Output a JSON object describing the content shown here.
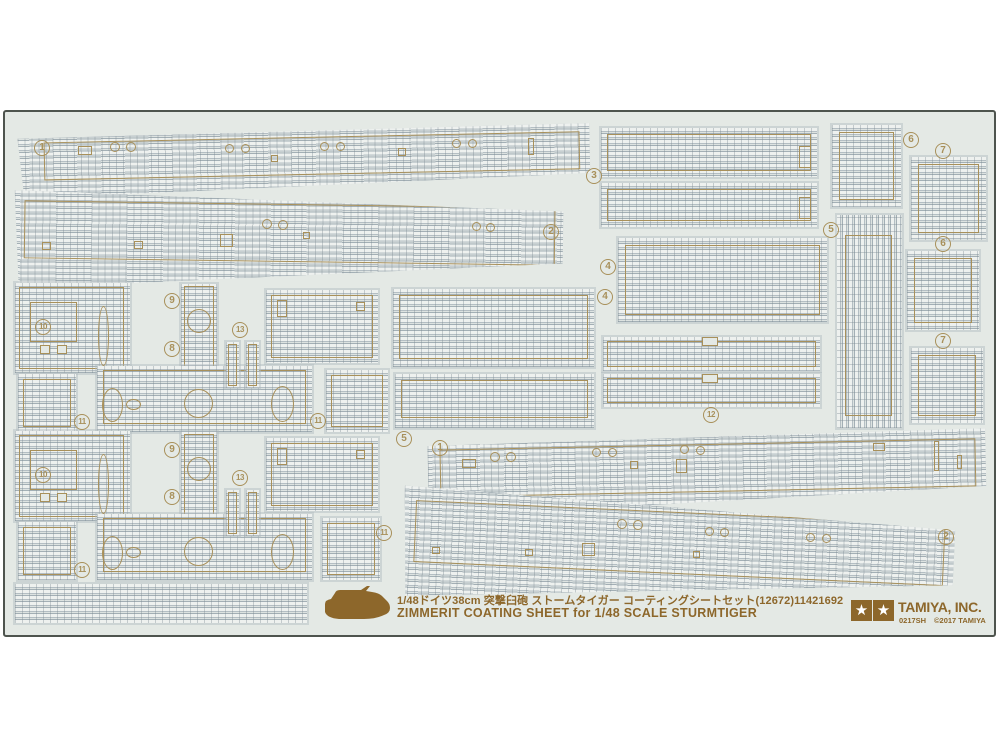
{
  "product": {
    "caption_jp": "1/48ドイツ38cm 突撃臼砲 ストームタイガー コーティングシートセット(12672)11421692",
    "caption_en": "ZIMMERIT COATING SHEET for 1/48 SCALE  STURMTIGER",
    "brand": "TAMIYA, INC.",
    "item_code": "0217SH",
    "copyright": "©2017 TAMIYA",
    "star_glyph": "★"
  },
  "colors": {
    "outline_tan": "#a8905a",
    "print_brown": "#8d672b",
    "sheet_bg": "#e4e9e5",
    "sheet_border": "#4e544e",
    "texture_base": "#d3dad9"
  },
  "part_badges": [
    {
      "n": "1",
      "x": 42,
      "y": 148
    },
    {
      "n": "2",
      "x": 551,
      "y": 232
    },
    {
      "n": "3",
      "x": 594,
      "y": 176
    },
    {
      "n": "4",
      "x": 608,
      "y": 267
    },
    {
      "n": "4",
      "x": 605,
      "y": 297
    },
    {
      "n": "5",
      "x": 831,
      "y": 230
    },
    {
      "n": "5",
      "x": 404,
      "y": 439
    },
    {
      "n": "6",
      "x": 911,
      "y": 140
    },
    {
      "n": "6",
      "x": 943,
      "y": 244
    },
    {
      "n": "7",
      "x": 943,
      "y": 151
    },
    {
      "n": "7",
      "x": 943,
      "y": 341
    },
    {
      "n": "8",
      "x": 172,
      "y": 349
    },
    {
      "n": "9",
      "x": 172,
      "y": 301
    },
    {
      "n": "10",
      "x": 43,
      "y": 327
    },
    {
      "n": "11",
      "x": 82,
      "y": 422
    },
    {
      "n": "11",
      "x": 318,
      "y": 421
    },
    {
      "n": "12",
      "x": 711,
      "y": 415
    },
    {
      "n": "13",
      "x": 240,
      "y": 330
    },
    {
      "n": "1",
      "x": 440,
      "y": 448
    },
    {
      "n": "2",
      "x": 946,
      "y": 537
    },
    {
      "n": "8",
      "x": 172,
      "y": 497
    },
    {
      "n": "9",
      "x": 172,
      "y": 450
    },
    {
      "n": "10",
      "x": 43,
      "y": 475
    },
    {
      "n": "11",
      "x": 82,
      "y": 570
    },
    {
      "n": "11",
      "x": 384,
      "y": 533
    },
    {
      "n": "13",
      "x": 240,
      "y": 478
    }
  ],
  "pieces": [
    {
      "x": 18,
      "y": 129,
      "w": 572,
      "h": 64,
      "rot": -1.2,
      "clip": "polygon(0 6%,100% 0,100% 78%,1% 100%)",
      "inset": [
        8,
        10,
        18,
        26
      ]
    },
    {
      "x": 14,
      "y": 194,
      "w": 549,
      "h": 98,
      "rot": 0.8,
      "clip": "polygon(0 0,100% 14%,100% 67%,1% 100%)",
      "inset": [
        10,
        8,
        30,
        10
      ]
    },
    {
      "x": 601,
      "y": 128,
      "w": 216,
      "h": 49,
      "inset": [
        6,
        6,
        6,
        6
      ]
    },
    {
      "x": 601,
      "y": 183,
      "w": 216,
      "h": 44,
      "inset": [
        6,
        6,
        6,
        6
      ]
    },
    {
      "x": 618,
      "y": 238,
      "w": 209,
      "h": 84,
      "inset": [
        7,
        7,
        7,
        7
      ]
    },
    {
      "x": 393,
      "y": 289,
      "w": 201,
      "h": 78,
      "inset": [
        6,
        6,
        8,
        6
      ]
    },
    {
      "x": 395,
      "y": 374,
      "w": 199,
      "h": 54,
      "inset": [
        6,
        6,
        10,
        6
      ]
    },
    {
      "x": 603,
      "y": 337,
      "w": 217,
      "h": 34,
      "inset": [
        4,
        4,
        4,
        4
      ]
    },
    {
      "x": 603,
      "y": 374,
      "w": 217,
      "h": 33,
      "inset": [
        4,
        4,
        4,
        4
      ]
    },
    {
      "x": 837,
      "y": 215,
      "w": 65,
      "h": 213,
      "v": true,
      "inset": [
        20,
        10,
        12,
        8
      ]
    },
    {
      "x": 832,
      "y": 125,
      "w": 69,
      "h": 82,
      "inset": [
        7,
        7,
        7,
        7
      ]
    },
    {
      "x": 911,
      "y": 157,
      "w": 75,
      "h": 83,
      "inset": [
        7,
        7,
        7,
        7
      ]
    },
    {
      "x": 907,
      "y": 251,
      "w": 72,
      "h": 79,
      "inset": [
        7,
        7,
        7,
        7
      ]
    },
    {
      "x": 911,
      "y": 348,
      "w": 72,
      "h": 75,
      "inset": [
        7,
        7,
        7,
        7
      ]
    },
    {
      "x": 15,
      "y": 283,
      "w": 115,
      "h": 90,
      "inset": [
        4,
        6,
        4,
        4
      ]
    },
    {
      "x": 181,
      "y": 284,
      "w": 36,
      "h": 122,
      "inset": [
        2,
        3,
        2,
        3
      ]
    },
    {
      "x": 266,
      "y": 290,
      "w": 112,
      "h": 73,
      "inset": [
        5,
        5,
        5,
        5
      ]
    },
    {
      "x": 97,
      "y": 366,
      "w": 215,
      "h": 66,
      "inset": [
        4,
        6,
        8,
        6
      ]
    },
    {
      "x": 18,
      "y": 374,
      "w": 58,
      "h": 58,
      "inset": [
        5,
        5,
        5,
        5
      ]
    },
    {
      "x": 326,
      "y": 370,
      "w": 62,
      "h": 62,
      "inset": [
        5,
        5,
        5,
        5
      ]
    },
    {
      "x": 226,
      "y": 342,
      "w": 13,
      "h": 46,
      "inset": [
        2,
        2,
        2,
        2
      ]
    },
    {
      "x": 246,
      "y": 342,
      "w": 13,
      "h": 46,
      "inset": [
        2,
        2,
        2,
        2
      ]
    },
    {
      "x": 15,
      "y": 431,
      "w": 115,
      "h": 90,
      "inset": [
        4,
        6,
        4,
        4
      ]
    },
    {
      "x": 181,
      "y": 432,
      "w": 36,
      "h": 122,
      "inset": [
        2,
        3,
        2,
        3
      ]
    },
    {
      "x": 266,
      "y": 438,
      "w": 112,
      "h": 73,
      "inset": [
        5,
        5,
        5,
        5
      ]
    },
    {
      "x": 97,
      "y": 514,
      "w": 215,
      "h": 66,
      "inset": [
        4,
        6,
        8,
        6
      ]
    },
    {
      "x": 18,
      "y": 522,
      "w": 58,
      "h": 58,
      "inset": [
        5,
        5,
        5,
        5
      ]
    },
    {
      "x": 322,
      "y": 518,
      "w": 58,
      "h": 62,
      "inset": [
        5,
        5,
        5,
        5
      ]
    },
    {
      "x": 226,
      "y": 490,
      "w": 13,
      "h": 46,
      "inset": [
        2,
        2,
        2,
        2
      ]
    },
    {
      "x": 246,
      "y": 490,
      "w": 13,
      "h": 46,
      "inset": [
        2,
        2,
        2,
        2
      ]
    },
    {
      "x": 428,
      "y": 434,
      "w": 558,
      "h": 78,
      "rot": -1.2,
      "clip": "polygon(0 8%,100% 0,100% 74%,0 100%)",
      "inset": [
        10,
        10,
        20,
        12
      ]
    },
    {
      "x": 402,
      "y": 498,
      "w": 552,
      "h": 110,
      "rot": 2.6,
      "clip": "polygon(0 0,100% 18%,100% 68%,1% 100%)",
      "inset": [
        14,
        10,
        34,
        12
      ]
    },
    {
      "x": 15,
      "y": 584,
      "w": 292,
      "h": 39
    }
  ],
  "decor": [
    {
      "t": "c",
      "x": 110,
      "y": 142,
      "w": 10,
      "h": 10
    },
    {
      "t": "c",
      "x": 126,
      "y": 142,
      "w": 10,
      "h": 10
    },
    {
      "t": "r",
      "x": 78,
      "y": 146,
      "w": 14,
      "h": 9
    },
    {
      "t": "c",
      "x": 225,
      "y": 144,
      "w": 9,
      "h": 9
    },
    {
      "t": "c",
      "x": 241,
      "y": 144,
      "w": 9,
      "h": 9
    },
    {
      "t": "r",
      "x": 271,
      "y": 155,
      "w": 7,
      "h": 7
    },
    {
      "t": "c",
      "x": 320,
      "y": 142,
      "w": 9,
      "h": 9
    },
    {
      "t": "c",
      "x": 336,
      "y": 142,
      "w": 9,
      "h": 9
    },
    {
      "t": "r",
      "x": 398,
      "y": 148,
      "w": 8,
      "h": 8
    },
    {
      "t": "c",
      "x": 452,
      "y": 139,
      "w": 9,
      "h": 9
    },
    {
      "t": "c",
      "x": 468,
      "y": 139,
      "w": 9,
      "h": 9
    },
    {
      "t": "r",
      "x": 528,
      "y": 138,
      "w": 6,
      "h": 17
    },
    {
      "t": "r",
      "x": 42,
      "y": 242,
      "w": 9,
      "h": 8
    },
    {
      "t": "r",
      "x": 134,
      "y": 241,
      "w": 9,
      "h": 8
    },
    {
      "t": "r",
      "x": 220,
      "y": 234,
      "w": 13,
      "h": 13
    },
    {
      "t": "c",
      "x": 262,
      "y": 219,
      "w": 10,
      "h": 10
    },
    {
      "t": "c",
      "x": 278,
      "y": 220,
      "w": 10,
      "h": 10
    },
    {
      "t": "r",
      "x": 303,
      "y": 232,
      "w": 7,
      "h": 7
    },
    {
      "t": "c",
      "x": 472,
      "y": 222,
      "w": 9,
      "h": 9
    },
    {
      "t": "c",
      "x": 486,
      "y": 223,
      "w": 9,
      "h": 9
    },
    {
      "t": "r",
      "x": 799,
      "y": 146,
      "w": 12,
      "h": 22
    },
    {
      "t": "r",
      "x": 799,
      "y": 197,
      "w": 12,
      "h": 22
    },
    {
      "t": "r",
      "x": 30,
      "y": 302,
      "w": 47,
      "h": 40
    },
    {
      "t": "o",
      "x": 98,
      "y": 306,
      "w": 11,
      "h": 60
    },
    {
      "t": "c",
      "x": 187,
      "y": 309,
      "w": 24,
      "h": 24
    },
    {
      "t": "x",
      "x": 40,
      "y": 345,
      "w": 10,
      "h": 9
    },
    {
      "t": "x",
      "x": 57,
      "y": 345,
      "w": 10,
      "h": 9
    },
    {
      "t": "o",
      "x": 102,
      "y": 388,
      "w": 21,
      "h": 34
    },
    {
      "t": "o",
      "x": 271,
      "y": 386,
      "w": 23,
      "h": 36
    },
    {
      "t": "c",
      "x": 184,
      "y": 389,
      "w": 29,
      "h": 29
    },
    {
      "t": "o",
      "x": 126,
      "y": 399,
      "w": 15,
      "h": 11
    },
    {
      "t": "r",
      "x": 277,
      "y": 300,
      "w": 10,
      "h": 17
    },
    {
      "t": "r",
      "x": 356,
      "y": 302,
      "w": 9,
      "h": 9
    },
    {
      "t": "r",
      "x": 30,
      "y": 450,
      "w": 47,
      "h": 40
    },
    {
      "t": "o",
      "x": 98,
      "y": 454,
      "w": 11,
      "h": 60
    },
    {
      "t": "c",
      "x": 187,
      "y": 457,
      "w": 24,
      "h": 24
    },
    {
      "t": "x",
      "x": 40,
      "y": 493,
      "w": 10,
      "h": 9
    },
    {
      "t": "x",
      "x": 57,
      "y": 493,
      "w": 10,
      "h": 9
    },
    {
      "t": "o",
      "x": 102,
      "y": 536,
      "w": 21,
      "h": 34
    },
    {
      "t": "o",
      "x": 271,
      "y": 534,
      "w": 23,
      "h": 36
    },
    {
      "t": "c",
      "x": 184,
      "y": 537,
      "w": 29,
      "h": 29
    },
    {
      "t": "o",
      "x": 126,
      "y": 547,
      "w": 15,
      "h": 11
    },
    {
      "t": "r",
      "x": 277,
      "y": 448,
      "w": 10,
      "h": 17
    },
    {
      "t": "r",
      "x": 356,
      "y": 450,
      "w": 9,
      "h": 9
    },
    {
      "t": "x",
      "x": 702,
      "y": 337,
      "w": 16,
      "h": 9
    },
    {
      "t": "x",
      "x": 702,
      "y": 374,
      "w": 16,
      "h": 9
    },
    {
      "t": "c",
      "x": 490,
      "y": 452,
      "w": 10,
      "h": 10
    },
    {
      "t": "c",
      "x": 506,
      "y": 452,
      "w": 10,
      "h": 10
    },
    {
      "t": "r",
      "x": 462,
      "y": 459,
      "w": 14,
      "h": 9
    },
    {
      "t": "c",
      "x": 592,
      "y": 448,
      "w": 9,
      "h": 9
    },
    {
      "t": "c",
      "x": 608,
      "y": 448,
      "w": 9,
      "h": 9
    },
    {
      "t": "r",
      "x": 630,
      "y": 461,
      "w": 8,
      "h": 8
    },
    {
      "t": "c",
      "x": 680,
      "y": 445,
      "w": 9,
      "h": 9
    },
    {
      "t": "c",
      "x": 696,
      "y": 446,
      "w": 9,
      "h": 9
    },
    {
      "t": "r",
      "x": 676,
      "y": 459,
      "w": 11,
      "h": 14
    },
    {
      "t": "r",
      "x": 873,
      "y": 443,
      "w": 12,
      "h": 8
    },
    {
      "t": "r",
      "x": 934,
      "y": 441,
      "w": 5,
      "h": 30
    },
    {
      "t": "r",
      "x": 957,
      "y": 455,
      "w": 5,
      "h": 14
    },
    {
      "t": "r",
      "x": 432,
      "y": 547,
      "w": 8,
      "h": 7
    },
    {
      "t": "r",
      "x": 525,
      "y": 549,
      "w": 8,
      "h": 7
    },
    {
      "t": "r",
      "x": 582,
      "y": 543,
      "w": 13,
      "h": 13
    },
    {
      "t": "c",
      "x": 617,
      "y": 519,
      "w": 10,
      "h": 10
    },
    {
      "t": "c",
      "x": 633,
      "y": 520,
      "w": 10,
      "h": 10
    },
    {
      "t": "r",
      "x": 693,
      "y": 551,
      "w": 7,
      "h": 7
    },
    {
      "t": "c",
      "x": 705,
      "y": 527,
      "w": 9,
      "h": 9
    },
    {
      "t": "c",
      "x": 720,
      "y": 528,
      "w": 9,
      "h": 9
    },
    {
      "t": "c",
      "x": 806,
      "y": 533,
      "w": 9,
      "h": 9
    },
    {
      "t": "c",
      "x": 822,
      "y": 534,
      "w": 9,
      "h": 9
    }
  ]
}
